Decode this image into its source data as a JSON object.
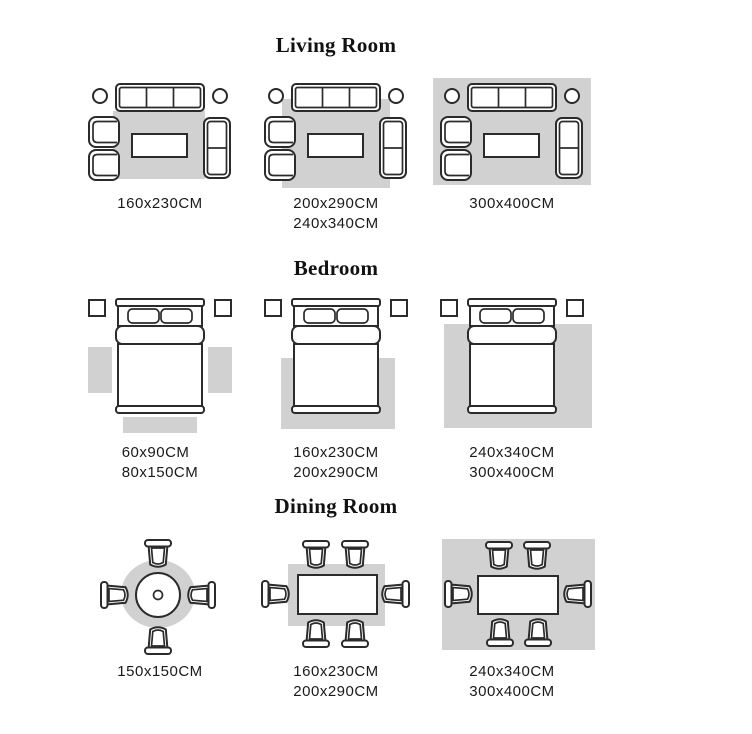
{
  "colors": {
    "background": "#ffffff",
    "rug": "#d1d1d1",
    "furniture_outline": "#2b2b2b",
    "furniture_fill": "#ffffff",
    "title_text": "#111111",
    "label_text": "#1a1a1a"
  },
  "furniture_icons": {
    "living_room": [
      "three-seat-sofa-icon",
      "side-table-icon",
      "armchair-icon",
      "loveseat-icon",
      "coffee-table-icon",
      "rug-shape"
    ],
    "bedroom": [
      "double-bed-icon",
      "nightstand-icon",
      "rug-shape"
    ],
    "dining_room": [
      "round-dining-table-icon",
      "rect-dining-table-icon",
      "dining-chair-icon",
      "rug-shape"
    ]
  },
  "sections": [
    {
      "title": "Living Room",
      "tiles": [
        {
          "sizes": [
            "160x230CM"
          ]
        },
        {
          "sizes": [
            "200x290CM",
            "240x340CM"
          ]
        },
        {
          "sizes": [
            "300x400CM"
          ]
        }
      ]
    },
    {
      "title": "Bedroom",
      "tiles": [
        {
          "sizes": [
            "60x90CM",
            "80x150CM"
          ]
        },
        {
          "sizes": [
            "160x230CM",
            "200x290CM"
          ]
        },
        {
          "sizes": [
            "240x340CM",
            "300x400CM"
          ]
        }
      ]
    },
    {
      "title": "Dining Room",
      "tiles": [
        {
          "sizes": [
            "150x150CM"
          ]
        },
        {
          "sizes": [
            "160x230CM",
            "200x290CM"
          ]
        },
        {
          "sizes": [
            "240x340CM",
            "300x400CM"
          ]
        }
      ]
    }
  ]
}
